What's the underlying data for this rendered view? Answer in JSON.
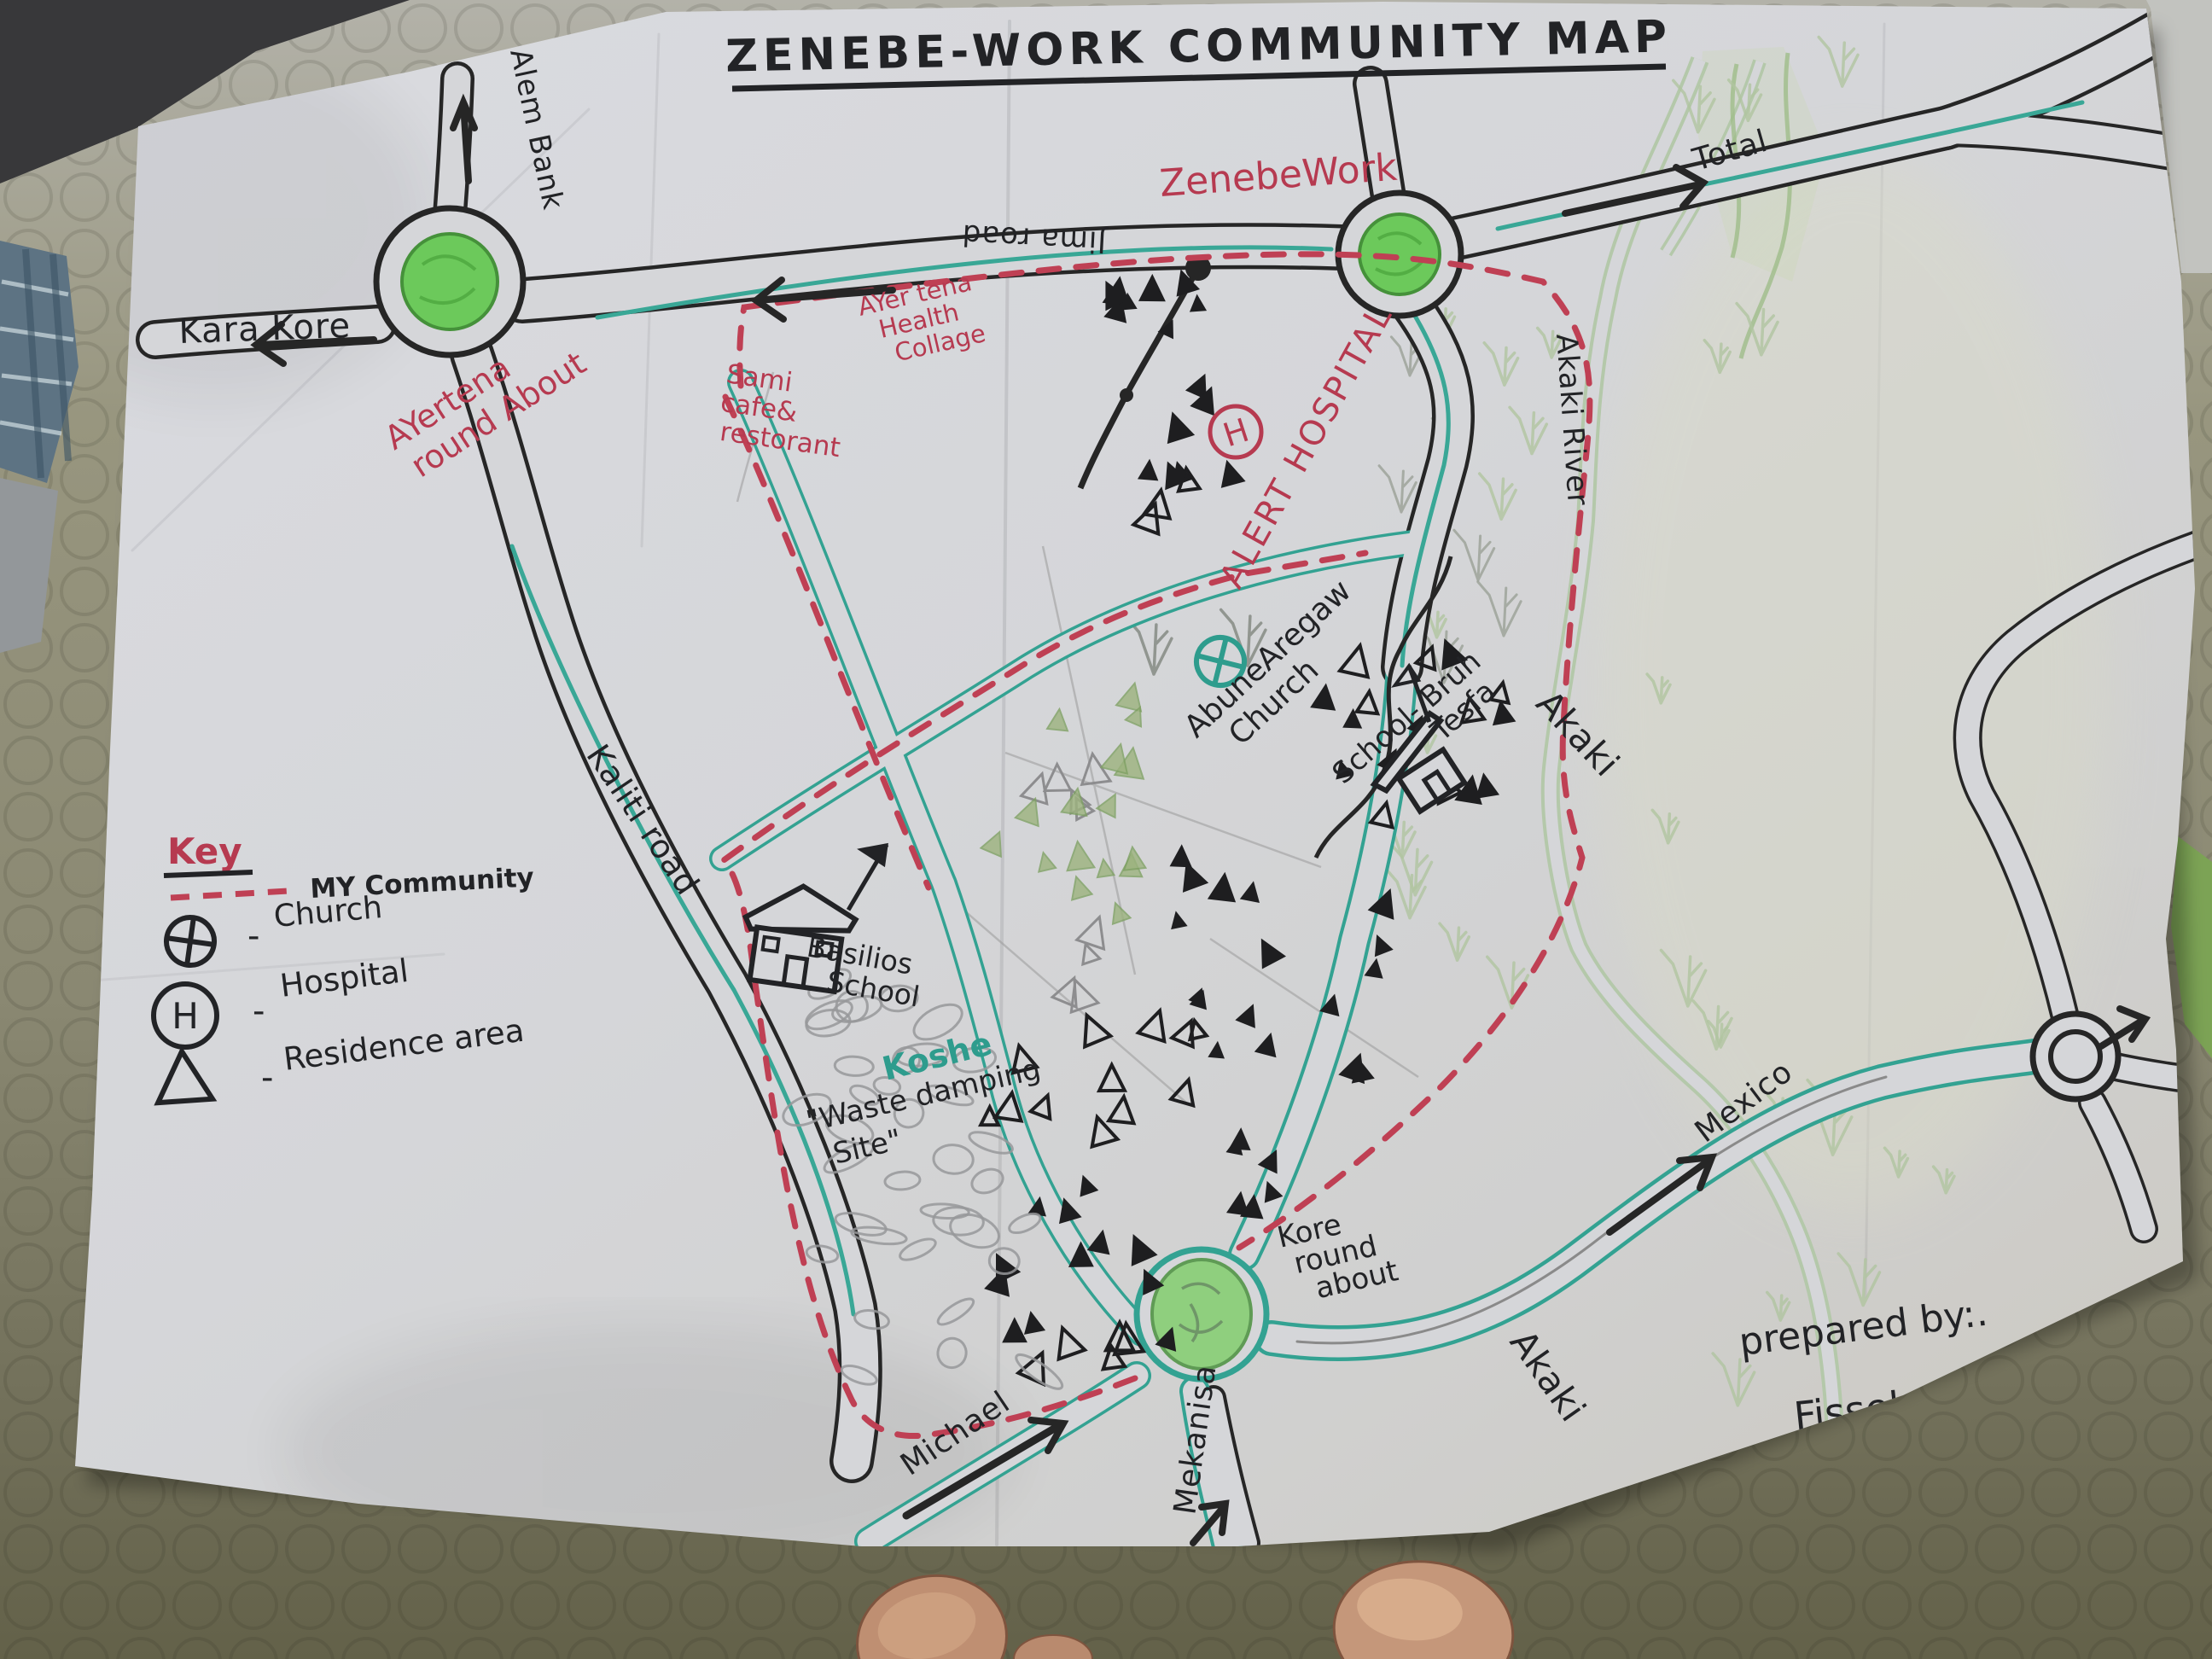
{
  "photo": {
    "title": "ZENEBE-WORK COMMUNITY MAP",
    "prepared_by": {
      "line1": "prepared by:.",
      "line2": "Fisseha Getahun",
      "line3": "March, 2016"
    }
  },
  "legend": {
    "heading": "Key",
    "dash": "-",
    "items": [
      {
        "symbol": "red-dashed-line",
        "label": "MY Community"
      },
      {
        "symbol": "circle-plus",
        "label": "Church"
      },
      {
        "symbol": "circle-h",
        "label": "Hospital"
      },
      {
        "symbol": "triangle",
        "label": "Residence area"
      }
    ]
  },
  "symbols": {
    "hospital": "H"
  },
  "colors": {
    "ink_black": "#222326",
    "ink_red": "#b63a50",
    "ink_teal": "#2e9c8d",
    "roundabout_green": "#6cc95b",
    "river_green": "#b4c8aa",
    "paper": "#d6d7d9"
  },
  "places": {
    "alem_bank": "Alem Bank",
    "kara_kore": "Kara Kore",
    "ayertena_line1": "AYertena",
    "ayertena_line2": "round About",
    "sami_line1": "Sami",
    "sami_line2": "cafe&",
    "sami_line3": "restorant",
    "jima_road": "Jima road",
    "health_line1": "AYer tena",
    "health_line2": "Health",
    "health_line3": "Collage",
    "zenebework": "ZenebeWork",
    "total": "Total",
    "alert_hospital": "ALERT HOSPITAL",
    "akaki_river": "Akaki River",
    "abune_line1": "AbuneAregaw",
    "abune_line2": "Church",
    "school_bruh_line1": "School- Bruh",
    "school_bruh_line2": "Tesfa",
    "akaki_mid": "Akaki",
    "kaliti_road": "Kaliti road",
    "basilios_line1": "Basilios",
    "basilios_line2": "School",
    "koshe": "Koshe",
    "waste_line1": "\"Waste damping",
    "waste_line2": "Site\"",
    "kore_line1": "Kore",
    "kore_line2": "round",
    "kore_line3": "about",
    "mexico": "Mexico",
    "michael": "Michael",
    "mekanisa": "Mekanisa",
    "akaki_bottom": "Akaki"
  }
}
